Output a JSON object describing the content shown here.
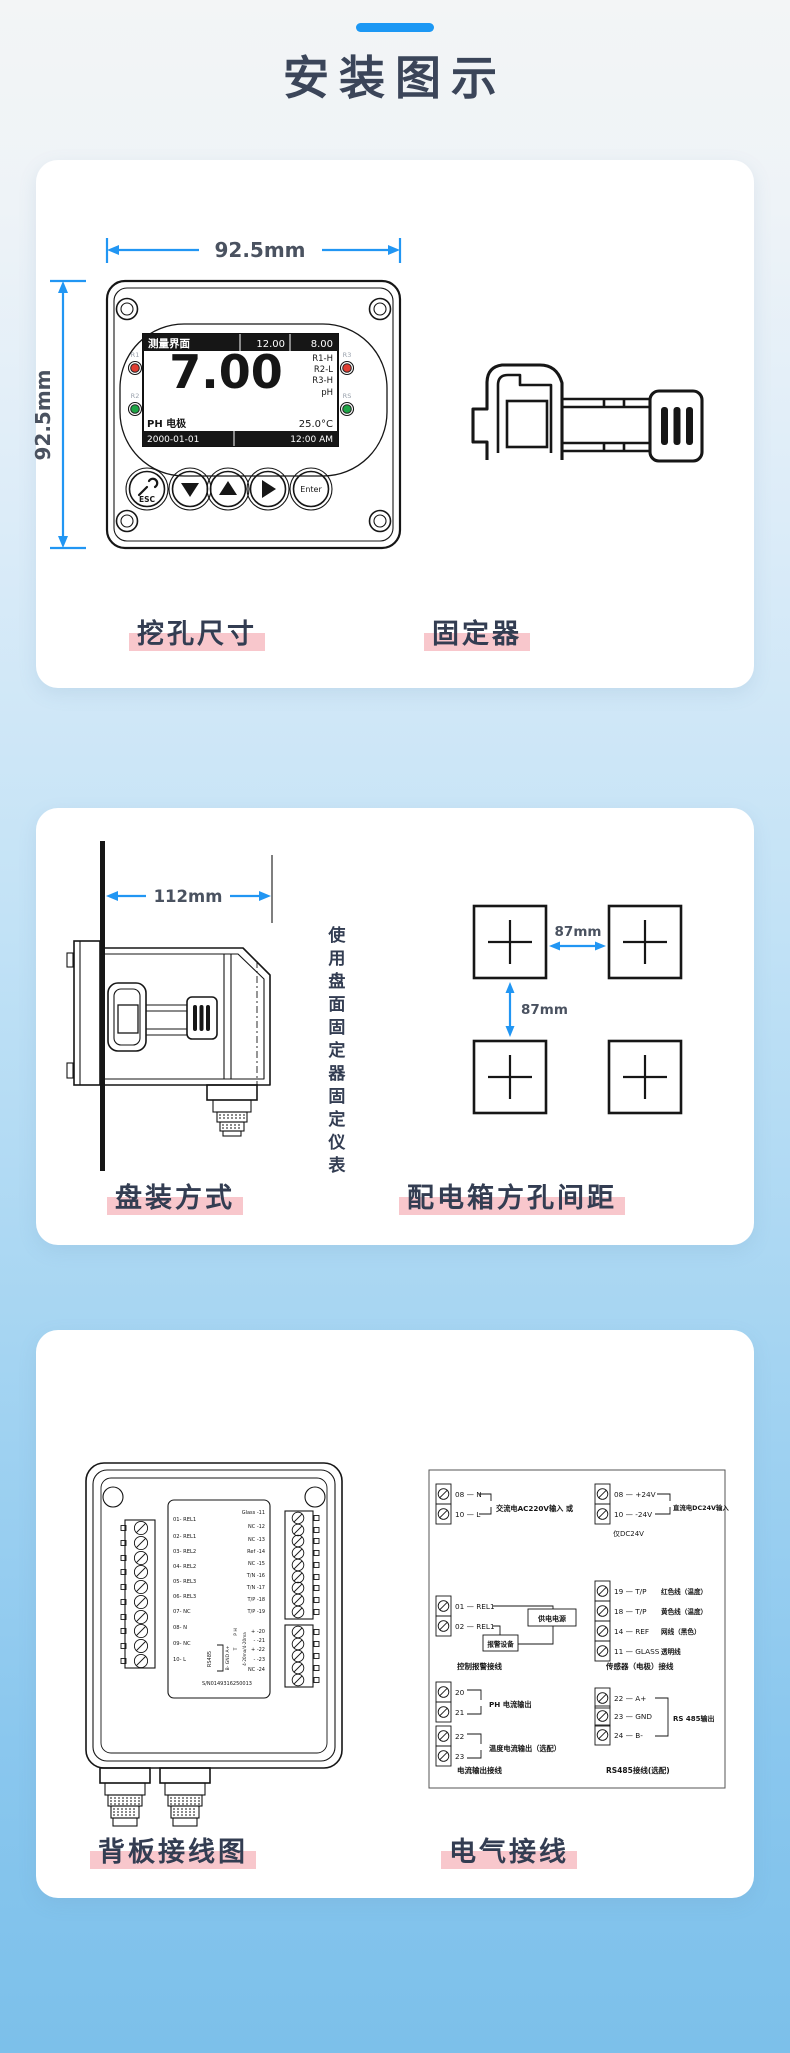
{
  "page": {
    "title": "安装图示"
  },
  "colors": {
    "accent": "#1c98f4",
    "dim_arrow": "#2196f3",
    "heading": "#3b4559",
    "caption_text": "#333d52",
    "highlight_pink": "#f8c7cc",
    "bg_top": "#f3f5f6",
    "bg_bottom": "#7cc0ea",
    "led_red": "#e03c31",
    "led_green": "#1ea546"
  },
  "s1": {
    "caption_left": "挖孔尺寸",
    "caption_right": "固定器",
    "dim_width": "92.5mm",
    "dim_height": "92.5mm",
    "lcd": {
      "title": "测量界面",
      "v1": "12.00",
      "v2": "8.00",
      "main": "7.00",
      "st1": "R1-H",
      "st2": "R2-L",
      "st3": "R3-H",
      "st4": "pH",
      "probe": "PH 电极",
      "temp": "25.0°C",
      "date": "2000-01-01",
      "time": "12:00 AM"
    },
    "leds": {
      "l1": "R1",
      "l2": "R2",
      "r1": "R3",
      "r2": "RS"
    },
    "keys": {
      "esc": "ESC",
      "enter": "Enter"
    }
  },
  "s2": {
    "caption_left": "盘装方式",
    "caption_right": "配电箱方孔间距",
    "dim_depth": "112mm",
    "note": "使用盘面固定器固定仪表",
    "gap_h": "87mm",
    "gap_v": "87mm"
  },
  "s3": {
    "caption_left": "背板接线图",
    "caption_right": "电气接线",
    "bp": {
      "left": [
        "01- REL1",
        "02- REL1",
        "03- REL2",
        "04- REL2",
        "05- REL3",
        "06- REL3",
        "07- NC",
        "08- N",
        "09- NC",
        "10- L"
      ],
      "right": [
        "Glass -11",
        "NC -12",
        "NC -13",
        "Ref -14",
        "NC -15",
        "T/N -16",
        "T/N -17",
        "T/P -18",
        "T/P -19",
        "+ -20",
        "- -21",
        "+ -22",
        "- -23",
        "NC -24"
      ],
      "rs485": "RS485",
      "pins": "B- GND A+",
      "ph": "P H",
      "tp": "T",
      "out": "4-20ma/4-20ma",
      "sn": "S/N0149316250013"
    },
    "w": {
      "ac1": "08 — N",
      "ac2": "10 — L",
      "ac_label": "交流电AC220V输入  或",
      "dc1": "08 — +24V",
      "dc2": "10 — -24V",
      "dc_label": "直流电DC24V输入",
      "dc_note": "仅DC24V",
      "rl1": "01 — REL1",
      "rl2": "02 — REL1",
      "box_power": "供电电源",
      "box_alarm": "报警设备",
      "cap_ctrl": "控制报警接线",
      "sn1": "19 — T/P",
      "sn1c": "红色线（温度）",
      "sn2": "18 — T/P",
      "sn2c": "黄色线（温度）",
      "sn3": "14 — REF",
      "sn3c": "网线（黑色）",
      "sn4": "11 — GLASS",
      "sn4c": "透明线",
      "cap_sensor": "传感器（电极）接线",
      "c1": "20",
      "c2": "21",
      "c3": "22",
      "c4": "23",
      "c_label1": "PH 电流输出",
      "c_label2": "温度电流输出（选配）",
      "cap_current": "电流输出接线",
      "r1": "22 — A+",
      "r2": "23 — GND",
      "r3": "24 — B-",
      "r_label": "RS 485输出",
      "cap_rs": "RS485接线(选配)"
    }
  }
}
